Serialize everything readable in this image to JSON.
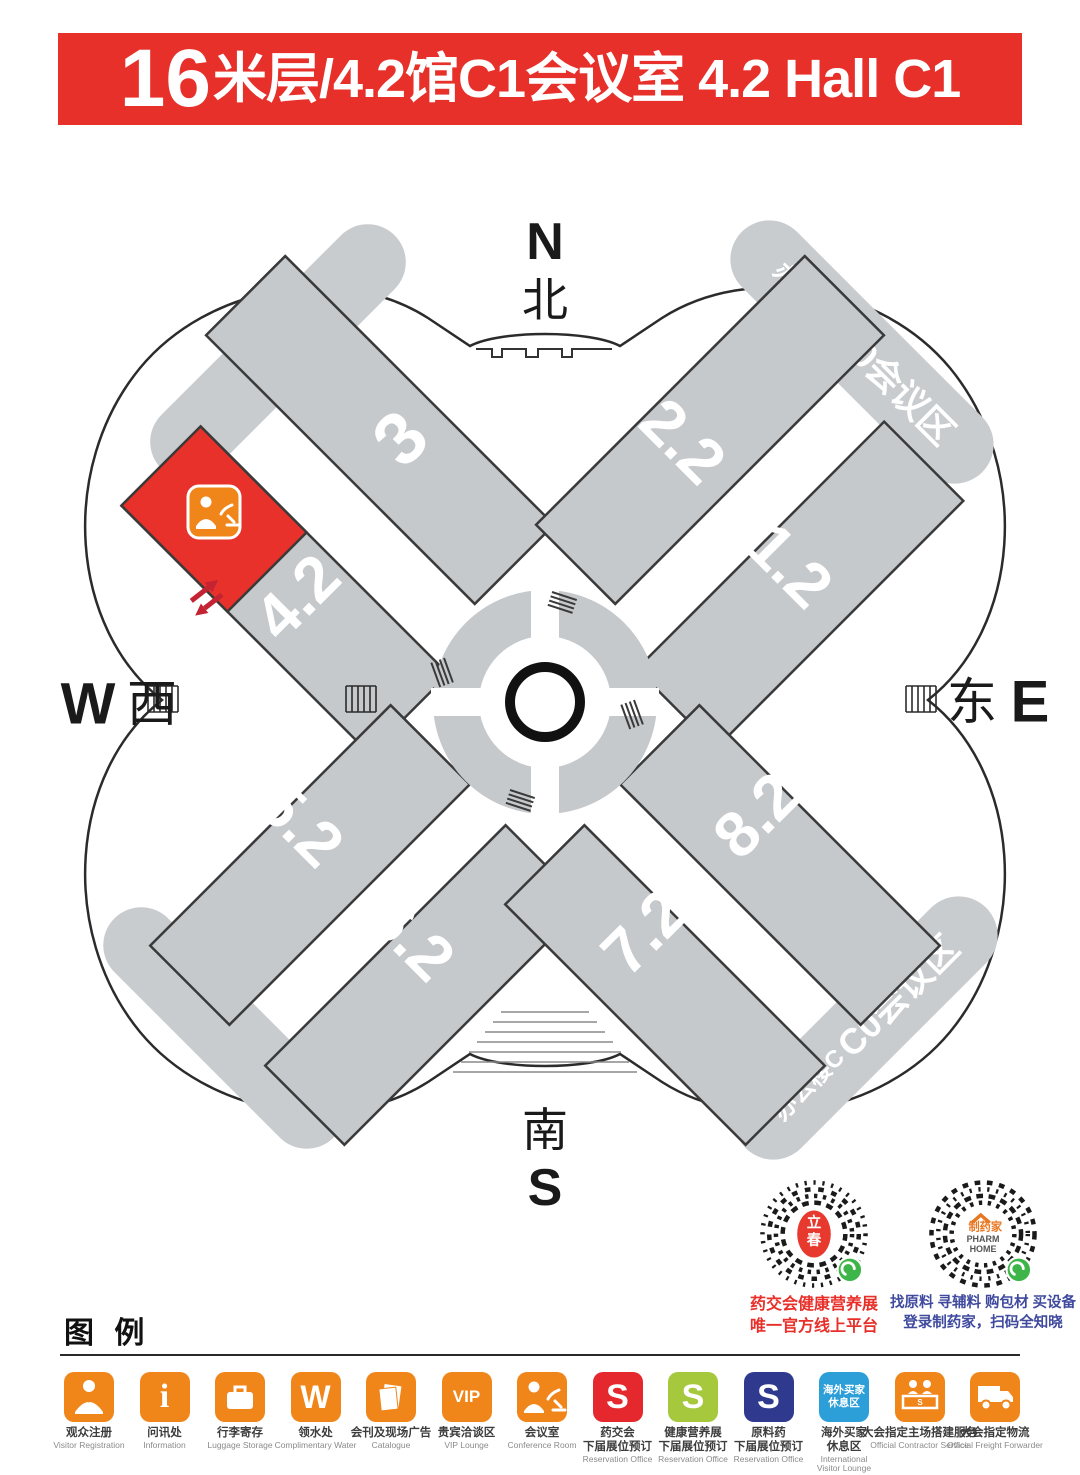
{
  "title": {
    "floor_big": "16",
    "rest": "米层/4.2馆C1会议室 4.2 Hall C1"
  },
  "colors": {
    "banner_red": "#E8302A",
    "highlight_red": "#E8312A",
    "icon_orange": "#F08519",
    "hall_gray": "#C6C9CC",
    "band_gray": "#C9CCCF",
    "s_red": "#E5282E",
    "s_green": "#A6C83D",
    "s_navy": "#2F3A8F",
    "lounge_blue": "#2D9FD8",
    "wechat_green": "#3EB548",
    "caption_blue": "#3F4A9E"
  },
  "map": {
    "compass": {
      "n": "N",
      "north": "北",
      "south": "南",
      "s": "S",
      "w": "W",
      "west": "西",
      "east": "东",
      "e": "E"
    },
    "halls": [
      {
        "label": "3"
      },
      {
        "label": "4.2"
      },
      {
        "label": "2.2"
      },
      {
        "label": "1.2"
      },
      {
        "label": "5.2"
      },
      {
        "label": "6.2"
      },
      {
        "label": "7.2"
      },
      {
        "label": "8.2"
      }
    ],
    "center_label": "O",
    "office_b": {
      "building": "办公楼B",
      "zone": "B0会议区"
    },
    "office_c": {
      "building": "办公楼C",
      "zone": "C0会议区"
    },
    "highlight": {
      "hall": "4.2",
      "room": "C1会议室"
    }
  },
  "qr_codes": [
    {
      "logo_char1": "立",
      "logo_char2": "春",
      "caption1": "药交会健康营养展",
      "caption2": "唯一官方线上平台"
    },
    {
      "logo_name": "制药家",
      "logo_sub1": "PHARM",
      "logo_sub2": "HOME",
      "caption1": "找原料 寻辅料 购包材 买设备",
      "caption2": "登录制药家，扫码全知晓"
    }
  ],
  "legend": {
    "header": "图 例",
    "items": [
      {
        "zh": "观众注册",
        "en": "Visitor Registration",
        "icon": "person-badge-icon",
        "color": "#F08519"
      },
      {
        "zh": "问讯处",
        "en": "Information",
        "glyph": "i",
        "color": "#F08519"
      },
      {
        "zh": "行李寄存",
        "en": "Luggage Storage",
        "icon": "suitcase-icon",
        "color": "#F08519"
      },
      {
        "zh": "领水处",
        "en": "Complimentary Water",
        "glyph": "W",
        "color": "#F08519"
      },
      {
        "zh": "会刊及现场广告",
        "en": "Catalogue",
        "icon": "papers-icon",
        "color": "#F08519"
      },
      {
        "zh": "贵宾洽谈区",
        "en": "VIP Lounge",
        "glyph": "VIP",
        "color": "#F08519"
      },
      {
        "zh": "会议室",
        "en": "Conference Room",
        "icon": "speaker-icon",
        "color": "#F08519"
      },
      {
        "zh": "药交会",
        "zh2": "下届展位预订",
        "en": "Reservation Office",
        "glyph": "S",
        "color": "#E5282E"
      },
      {
        "zh": "健康营养展",
        "zh2": "下届展位预订",
        "en": "Reservation Office",
        "glyph": "S",
        "color": "#A6C83D"
      },
      {
        "zh": "原料药",
        "zh2": "下届展位预订",
        "en": "Reservation Office",
        "glyph": "S",
        "color": "#2F3A8F"
      },
      {
        "zh": "海外买家",
        "zh2": "休息区",
        "en": "International",
        "en2": "Visitor Lounge",
        "icon_text1": "海外买家",
        "icon_text2": "休息区",
        "color": "#2D9FD8"
      },
      {
        "zh": "大会指定主场搭建服务",
        "en": "Official Contractor Service",
        "icon": "service-desk-icon",
        "color": "#F08519"
      },
      {
        "zh": "大会指定物流",
        "en": "Official Freight Forwarder",
        "icon": "truck-icon",
        "color": "#F08519"
      }
    ]
  }
}
